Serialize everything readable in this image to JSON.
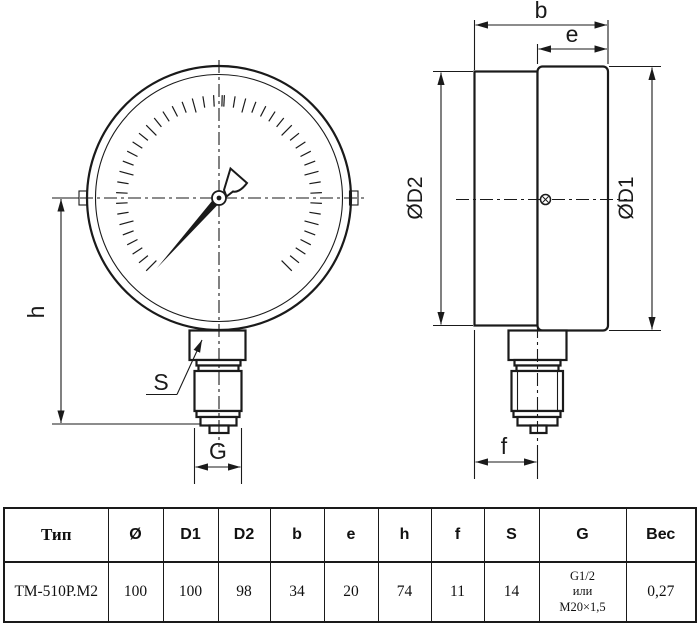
{
  "drawing": {
    "labels": {
      "h": "h",
      "S": "S",
      "G": "G",
      "b": "b",
      "e": "e",
      "f": "f",
      "d1": "ØD1",
      "d2": "ØD2"
    }
  },
  "table": {
    "headers": [
      "Тип",
      "Ø",
      "D1",
      "D2",
      "b",
      "e",
      "h",
      "f",
      "S",
      "G",
      "Вес"
    ],
    "row": [
      "ТМ-510Р.М2",
      "100",
      "100",
      "98",
      "34",
      "20",
      "74",
      "11",
      "14",
      "G1/2\nили\nМ20×1,5",
      "0,27"
    ]
  },
  "colors": {
    "line": "#1a1a1a",
    "background": "#ffffff"
  }
}
